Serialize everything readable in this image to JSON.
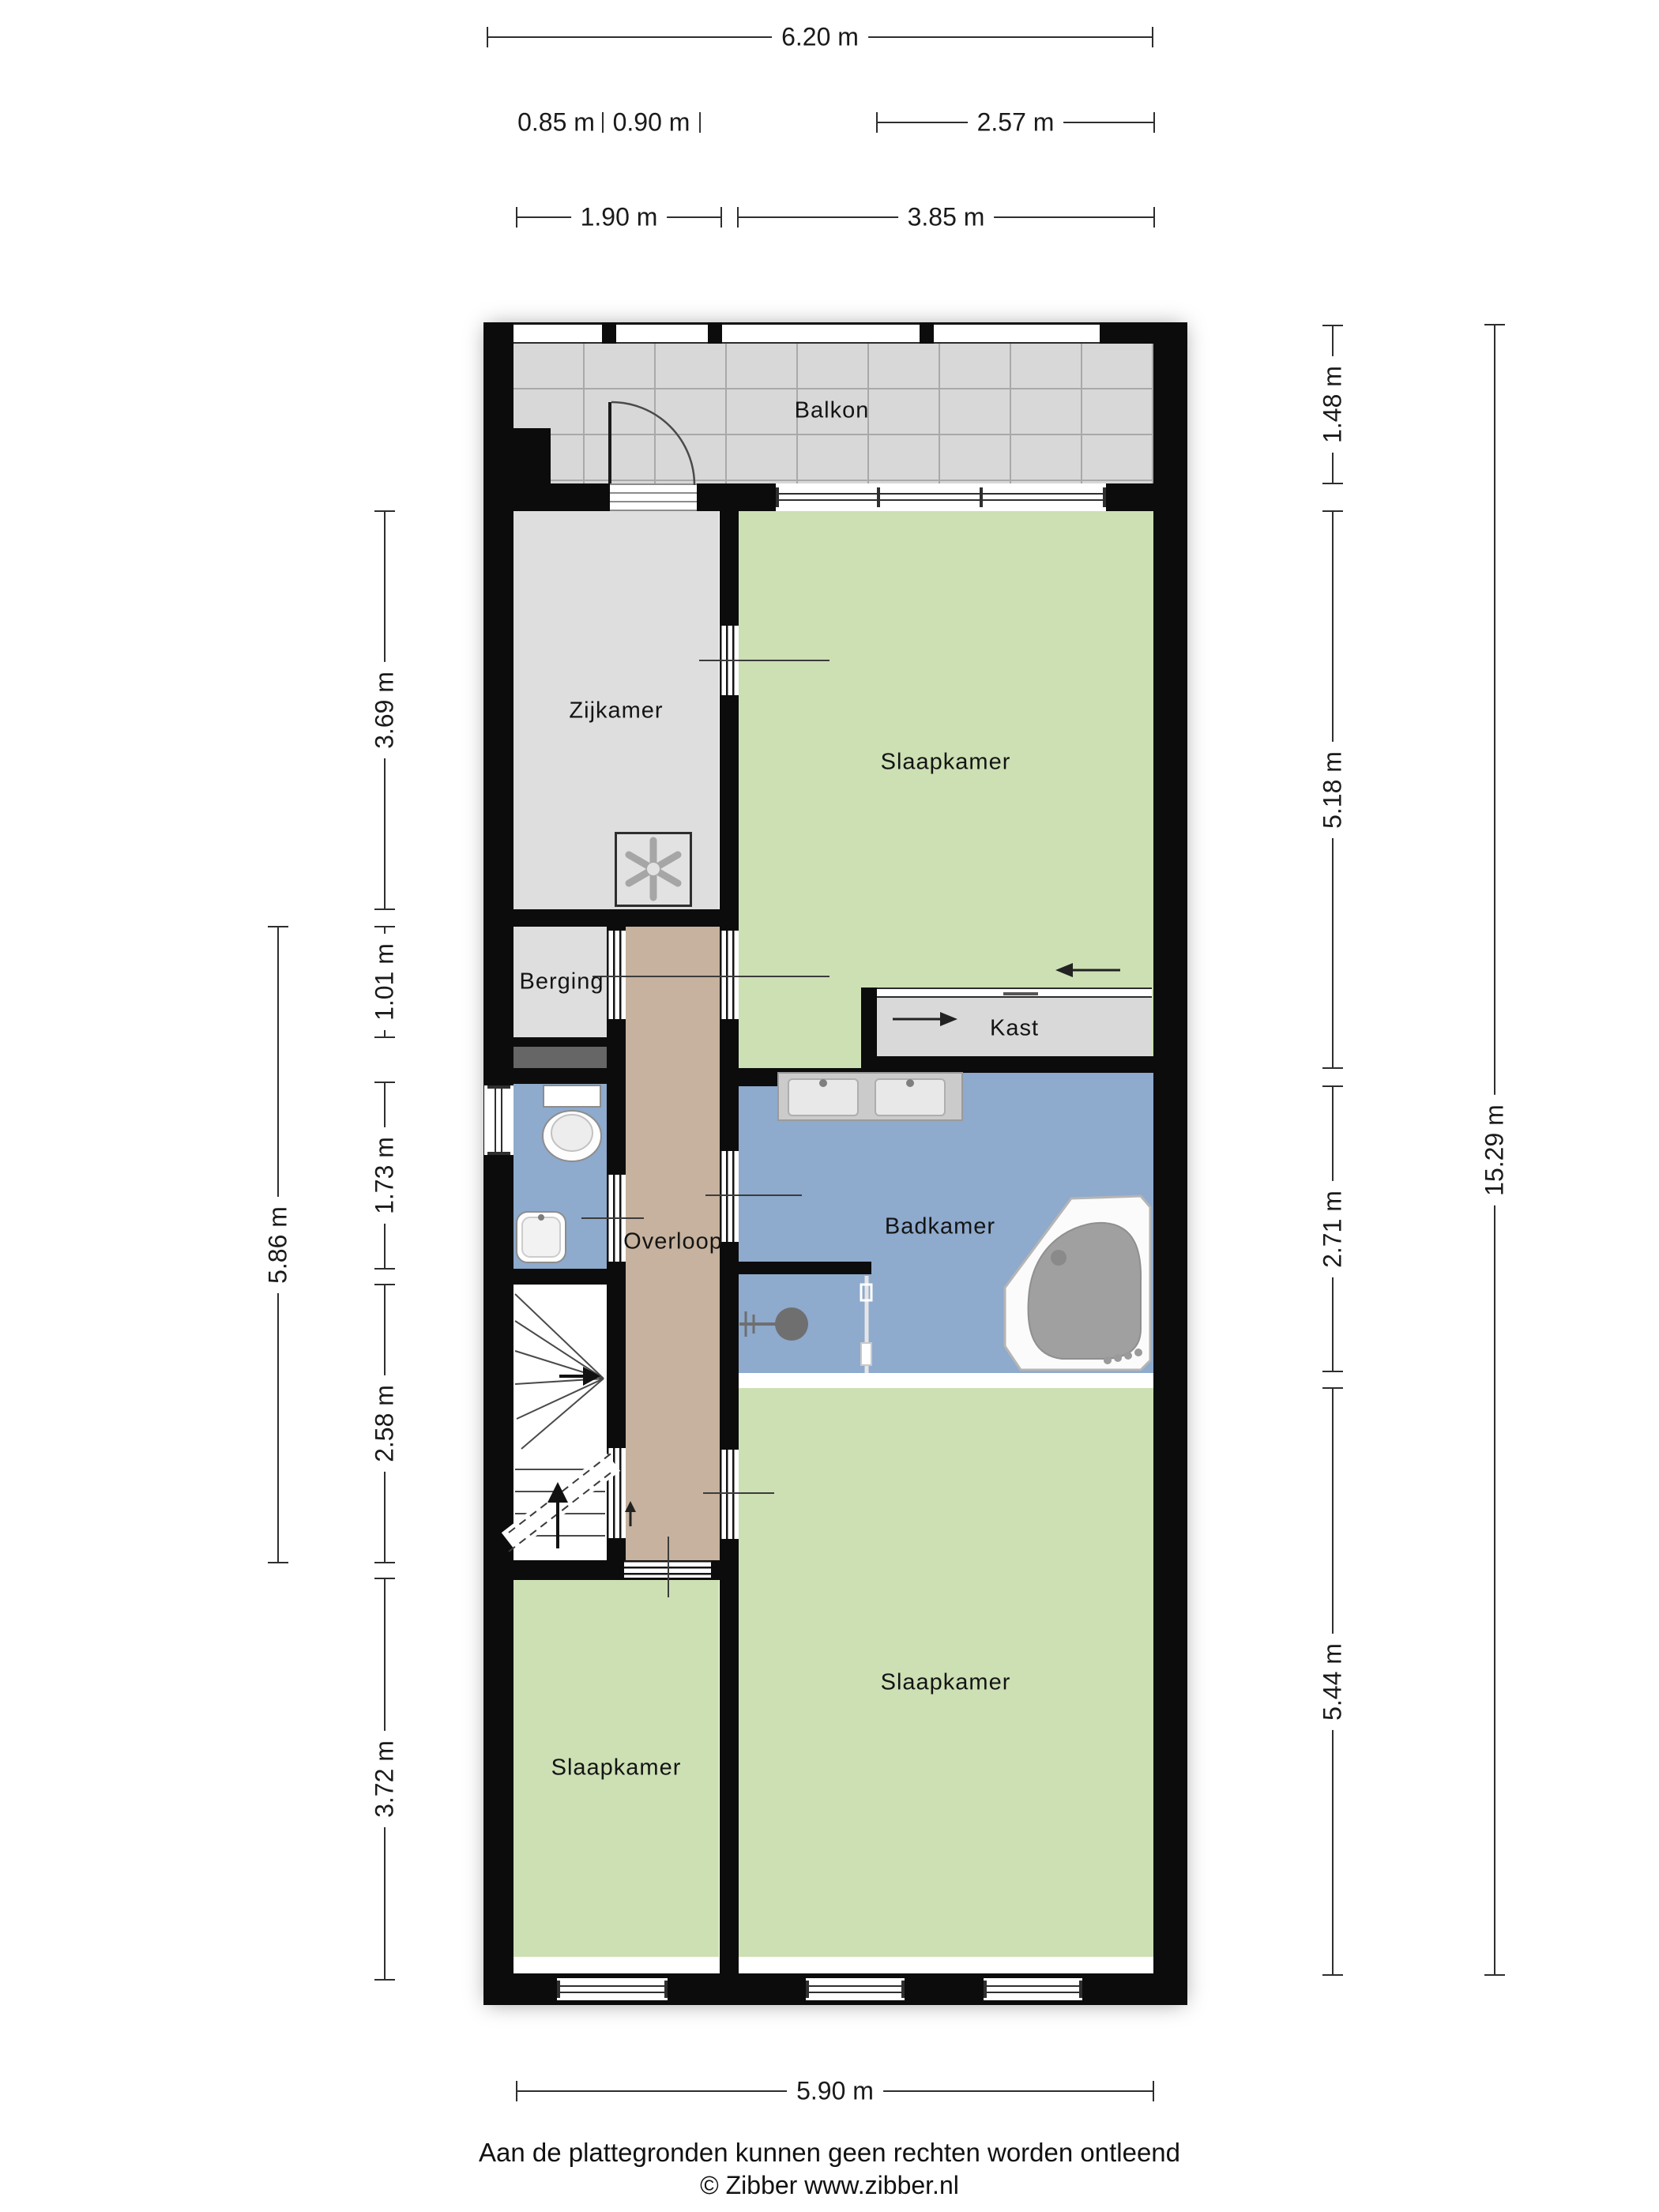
{
  "rooms": {
    "balkon": "Balkon",
    "zijkamer": "Zijkamer",
    "slaapkamer_top": "Slaapkamer",
    "berging": "Berging",
    "kast": "Kast",
    "overloop": "Overloop",
    "badkamer": "Badkamer",
    "slaapkamer_bottom_right": "Slaapkamer",
    "slaapkamer_bottom_left": "Slaapkamer"
  },
  "dimensions": {
    "top": {
      "total_width": "6.20 m",
      "berging_width": "0.85 m",
      "overloop_width": "0.90 m",
      "kast_width": "2.57 m",
      "zijkamer_width": "1.90 m",
      "slaapkamer_width": "3.85 m"
    },
    "bottom": {
      "interior_width": "5.90 m"
    },
    "right": {
      "balkon_depth": "1.48 m",
      "slaapkamer_top_height": "5.18 m",
      "badkamer_height": "2.71 m",
      "slaapkamer_bottom_height": "5.44 m",
      "total_height": "15.29 m"
    },
    "left": {
      "zijkamer_height": "3.69 m",
      "berging_height": "1.01 m",
      "toilet_height": "1.73 m",
      "stairs_height": "2.58 m",
      "slaapkamer_height": "3.72 m",
      "middle_section_height": "5.86 m"
    }
  },
  "footer": {
    "disclaimer": "Aan de plattegronden kunnen geen rechten worden ontleend",
    "copyright": "© Zibber www.zibber.nl"
  },
  "colors": {
    "wall": "#0c0c0c",
    "room_green": "#cde0b4",
    "room_blue": "#8eaacd",
    "room_grey": "#dedede",
    "corridor_tan": "#c6b29e",
    "balcony_grey": "#d8d8d8"
  }
}
